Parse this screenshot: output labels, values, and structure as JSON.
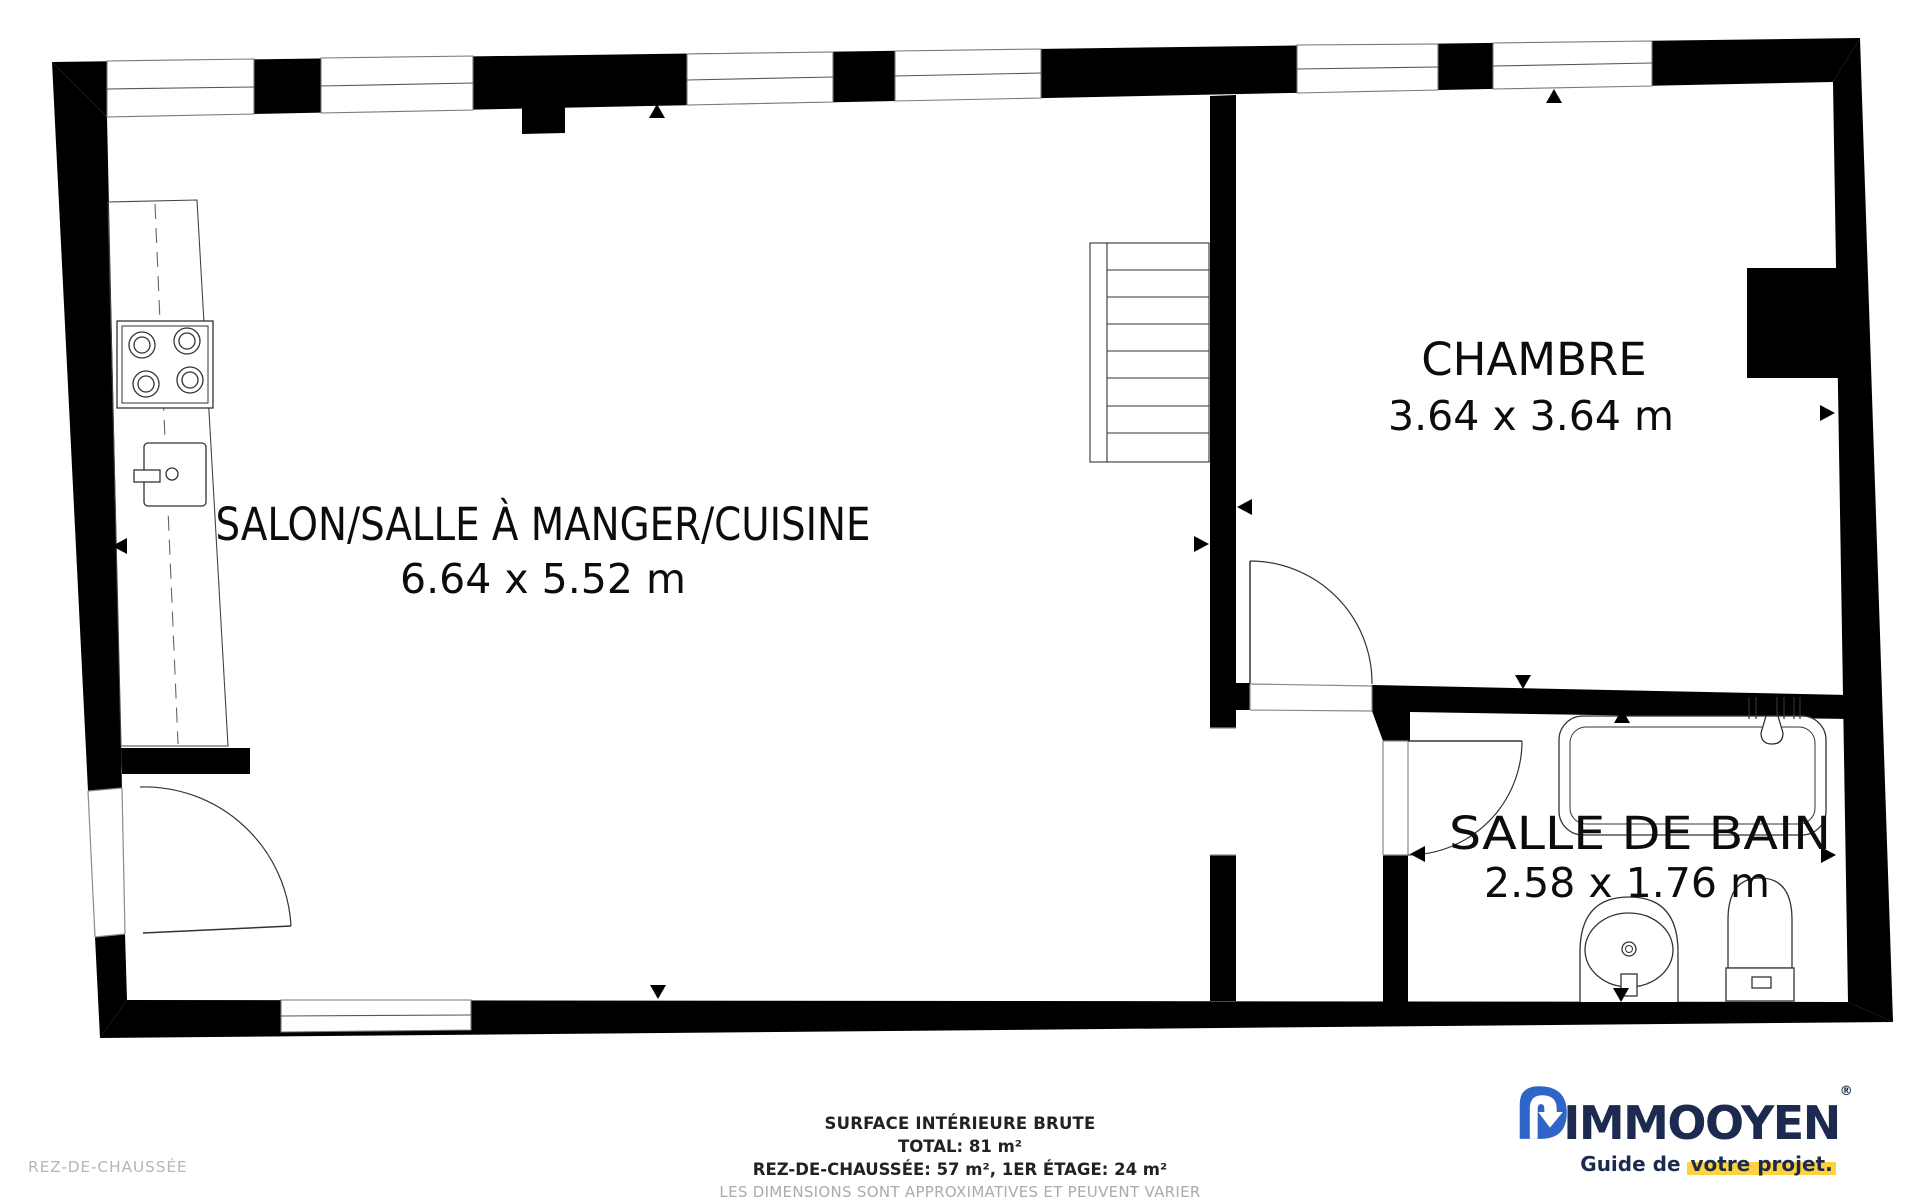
{
  "plan": {
    "floor": "REZ-DE-CHAUSSÉE",
    "rooms": {
      "living": {
        "name": "SALON/SALLE À MANGER/CUISINE",
        "dimensions": "6.64 x 5.52 m"
      },
      "bedroom": {
        "name": "CHAMBRE",
        "dimensions": "3.64 x 3.64 m"
      },
      "bathroom": {
        "name": "SALLE DE BAIN",
        "dimensions": "2.58 x 1.76 m"
      }
    },
    "icons": {
      "window": "double-line wall opening",
      "door_swing": "quarter-circle arc with leaf",
      "staircase": "8-tread stair run",
      "stove": "4-burner cooktop",
      "kitchen_sink": "sink with faucet",
      "bathtub": "tub with shower head",
      "washbasin": "pedestal basin",
      "toilet": "toilet with tank",
      "dimension_arrow": "small black triangle marker"
    }
  },
  "footer": {
    "surface_title": "SURFACE INTÉRIEURE BRUTE",
    "total": "TOTAL: 81 m²",
    "breakdown": "REZ-DE-CHAUSSÉE: 57 m², 1ER ÉTAGE: 24 m²",
    "disclaimer": "LES DIMENSIONS SONT APPROXIMATIVES ET PEUVENT VARIER",
    "floor_label": "REZ-DE-CHAUSSÉE"
  },
  "logo": {
    "brand_prefix": "IMMO",
    "brand_suffix": "OYEN",
    "registered": "®",
    "tagline_prefix": "Guide de ",
    "tagline_highlight": "votre projet.",
    "colors": {
      "navy": "#1b2a4e",
      "blue": "#2f65c9",
      "yellow": "#fdd23e"
    }
  }
}
